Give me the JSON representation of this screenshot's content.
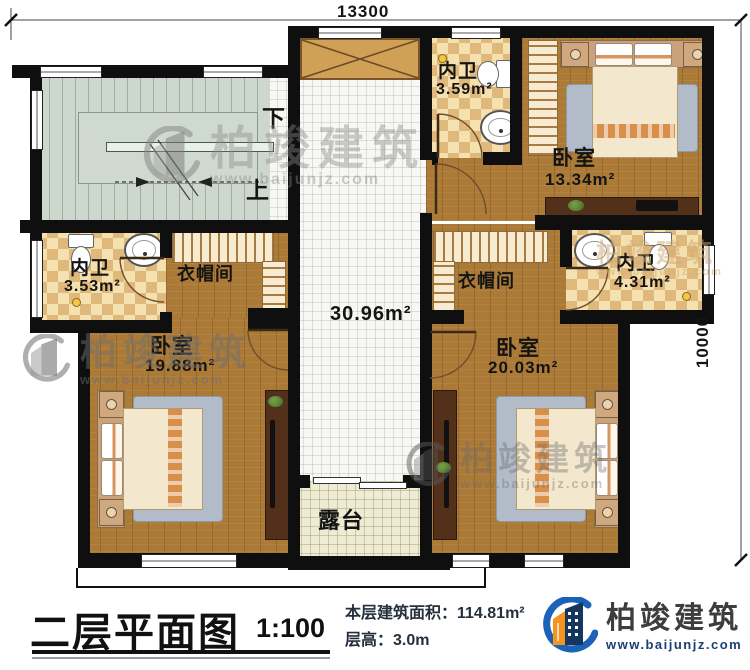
{
  "dimensions": {
    "top": "13300",
    "right": "10000"
  },
  "stairs": {
    "down": "下",
    "up": "上"
  },
  "rooms": {
    "hall": {
      "area": "30.96m²"
    },
    "bath_top": {
      "name": "内卫",
      "area": "3.59m²"
    },
    "bed_top_right": {
      "name": "卧室",
      "area": "13.34m²"
    },
    "bath_right": {
      "name": "内卫",
      "area": "4.31m²"
    },
    "closet_right": {
      "name": "衣帽间"
    },
    "bath_left": {
      "name": "内卫",
      "area": "3.53m²"
    },
    "closet_left": {
      "name": "衣帽间"
    },
    "bed_bottom_left": {
      "name": "卧室",
      "area": "19.88m²"
    },
    "bed_bottom_right": {
      "name": "卧室",
      "area": "20.03m²"
    },
    "terrace": {
      "name": "露台"
    }
  },
  "title_block": {
    "title": "二层平面图",
    "scale": "1:100",
    "area_label": "本层建筑面积：",
    "area_value": "114.81m²",
    "height_label": "层高：",
    "height_value": "3.0m"
  },
  "brand": {
    "name": "柏竣建筑",
    "url": "www.baijunjz.com"
  },
  "watermark": {
    "name": "柏竣建筑",
    "url": "www.baijunjz.com"
  },
  "colors": {
    "wall": "#0f0f0f",
    "wood": "#ac7a37",
    "checker": "#dfb87c",
    "logo_blue": "#1c63b7",
    "logo_navy": "#17365f",
    "logo_orange": "#f7941d"
  }
}
